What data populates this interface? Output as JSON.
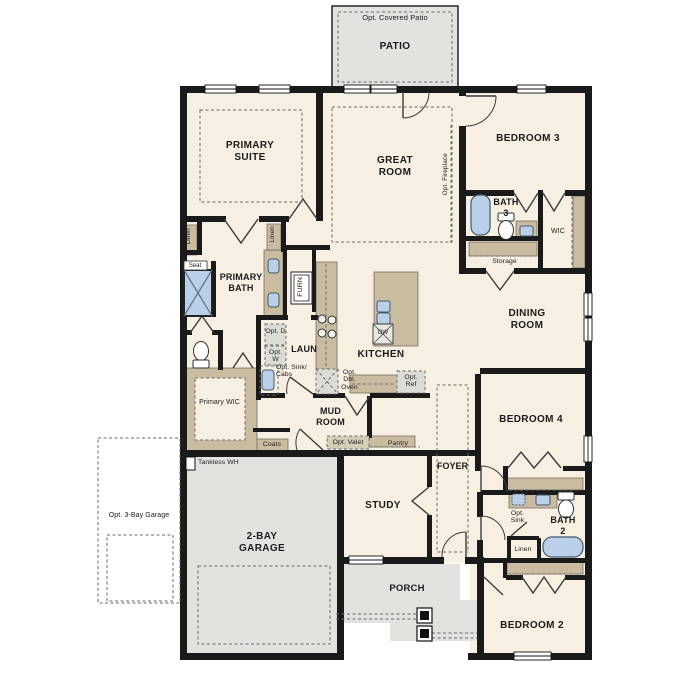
{
  "colors": {
    "wall": "#1a1a1a",
    "interior_floor": "#f6efe2",
    "hardscape_floor": "#e3e2de",
    "cabinetry": "#cabca1",
    "fixture_blue": "#b9d0e8",
    "dashed_line": "#6a6a6a"
  },
  "labels": {
    "opt_covered_patio": "Opt. Covered Patio",
    "patio": "PATIO",
    "primary_suite": "PRIMARY SUITE",
    "great_room": "GREAT ROOM",
    "bedroom_3": "BEDROOM 3",
    "bath_3": "BATH 3",
    "wic": "WIC",
    "storage": "Storage",
    "opt_fireplace": "Opt. Fireplace",
    "dining_room": "DINING ROOM",
    "linen_a": "Linen",
    "linen_b": "Linen",
    "linen_c": "Linen",
    "seat": "Seat",
    "primary_bath": "PRIMARY BATH",
    "furn": "FURN",
    "opt_d": "Opt. D",
    "opt_w": "Opt. W",
    "laun": "LAUN",
    "opt_sink_cabs": "Opt. Sink/ Cabs",
    "kitchen": "KITCHEN",
    "dw": "DW",
    "opt_dbl_oven": "Opt. Dbl. Oven",
    "opt_ref": "Opt. Ref",
    "primary_wic": "Primary WIC",
    "mud_room": "MUD ROOM",
    "coats": "Coats",
    "opt_valet": "Opt. Valet",
    "pantry": "Pantry",
    "foyer": "FOYER",
    "study": "STUDY",
    "bedroom_4": "BEDROOM 4",
    "opt_sink": "Opt. Sink",
    "bath_2": "BATH 2",
    "bedroom_2": "BEDROOM 2",
    "tankless_wh": "Tankless WH",
    "garage_2bay": "2-BAY GARAGE",
    "opt_3bay_garage": "Opt. 3-Bay Garage",
    "porch": "PORCH"
  }
}
